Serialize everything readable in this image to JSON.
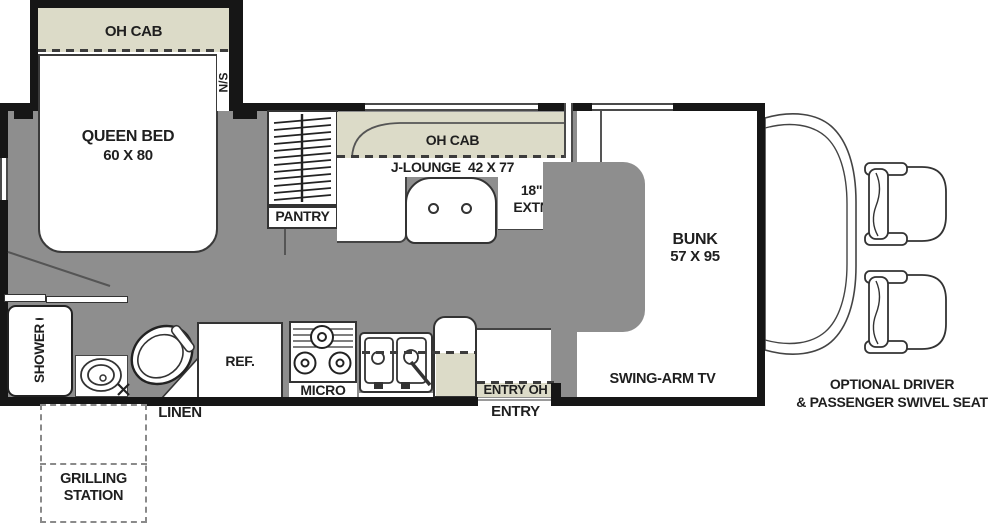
{
  "title": "RV floor plan",
  "colors": {
    "floor": "#8e8e8e",
    "cabinet": "#dcdbc8",
    "wall": "#161616"
  },
  "bedroom": {
    "oh_cab": "OH CAB",
    "nightstand": "N/S",
    "bed_line1": "QUEEN BED",
    "bed_line2": "60 X 80",
    "pantry": "PANTRY"
  },
  "lounge": {
    "oh_cab": "OH CAB",
    "label": "J-LOUNGE  42 X 77",
    "extn_line1": "18\"",
    "extn_line2": "EXTN"
  },
  "front": {
    "bunk_line1": "BUNK",
    "bunk_line2": "57 X 95",
    "tv": "SWING-ARM TV",
    "seats_line1": "OPTIONAL DRIVER",
    "seats_line2": "& PASSENGER SWIVEL SEAT"
  },
  "kitchen": {
    "ref": "REF.",
    "micro": "MICRO",
    "entry_oh": "ENTRY OH",
    "entry": "ENTRY"
  },
  "bath": {
    "shower": "SHOWER",
    "linen": "LINEN",
    "grill_line1": "GRILLING",
    "grill_line2": "STATION"
  }
}
